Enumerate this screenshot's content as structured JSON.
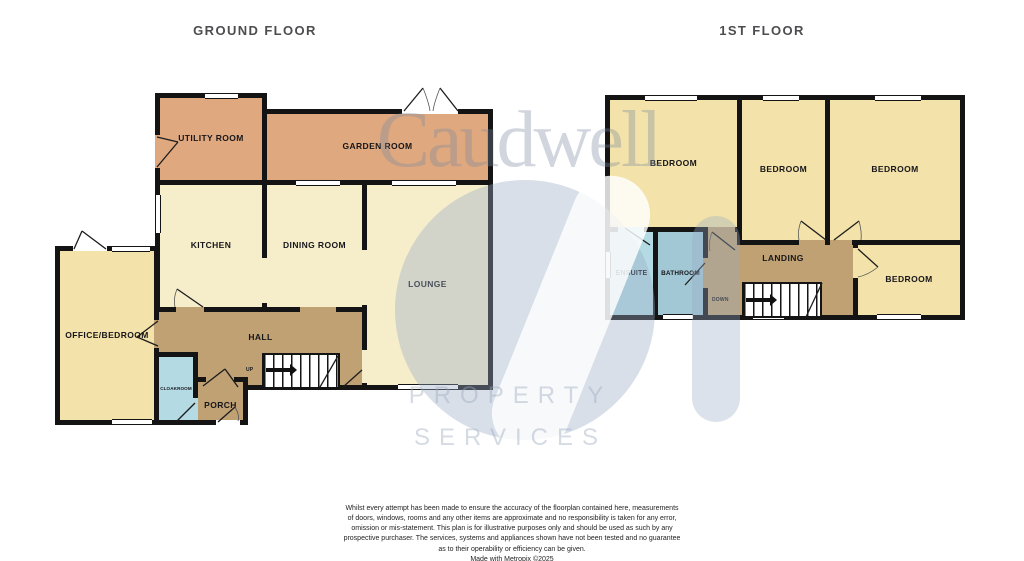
{
  "ground_floor": {
    "title": "GROUND FLOOR",
    "rooms": {
      "utility": {
        "label": "UTILITY ROOM"
      },
      "garden": {
        "label": "GARDEN ROOM"
      },
      "kitchen": {
        "label": "KITCHEN"
      },
      "dining": {
        "label": "DINING ROOM"
      },
      "lounge": {
        "label": "LOUNGE"
      },
      "office": {
        "label": "OFFICE/BEDROOM"
      },
      "hall": {
        "label": "HALL"
      },
      "cloakroom": {
        "label": "CLOAKROOM"
      },
      "porch": {
        "label": "PORCH"
      },
      "stairs": {
        "label": "UP"
      }
    }
  },
  "first_floor": {
    "title": "1ST FLOOR",
    "rooms": {
      "bedroom1": {
        "label": "BEDROOM"
      },
      "bedroom2": {
        "label": "BEDROOM"
      },
      "bedroom3": {
        "label": "BEDROOM"
      },
      "bedroom4": {
        "label": "BEDROOM"
      },
      "ensuite": {
        "label": "ENSUITE"
      },
      "bathroom": {
        "label": "BATHROOM"
      },
      "landing": {
        "label": "LANDING"
      },
      "stairs": {
        "label": "DOWN"
      }
    }
  },
  "watermark": {
    "brand": "Caudwell",
    "word1": "PROPERTY",
    "word2": "SERVICES"
  },
  "disclaimer": {
    "lines": [
      "Whilst every attempt has been made to ensure the accuracy of the floorplan contained here, measurements",
      "of doors, windows, rooms and any other items are approximate and no responsibility is taken for any error,",
      "omission or mis-statement. This plan is for illustrative purposes only and should be used as such by any",
      "prospective purchaser. The services, systems and appliances shown have not been tested and no guarantee",
      "as to their operability or efficiency can be given.",
      "Made with Metropix ©2025"
    ]
  },
  "colors": {
    "wall": "#141414",
    "room_cream": "#f6eecb",
    "room_yellow": "#f3e2a9",
    "room_salmon": "#dfa87e",
    "room_tan": "#bfa173",
    "room_blue": "#a2c8d5",
    "room_lightblue": "#b4dbe4",
    "title_text": "#4d4d50",
    "watermark_gray": "#c9cfd8"
  }
}
